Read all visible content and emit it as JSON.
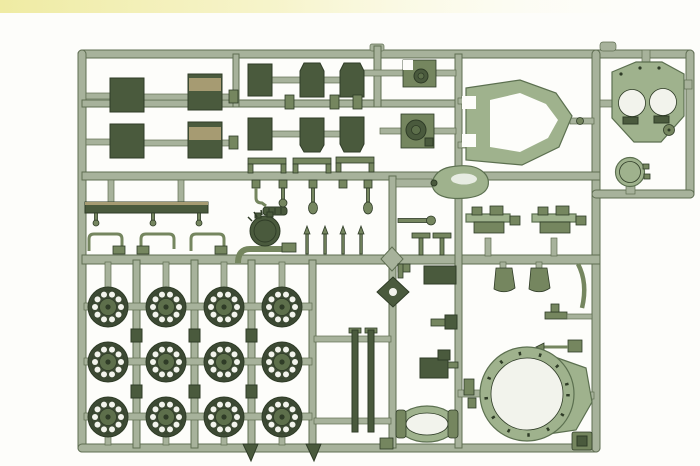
{
  "scene": {
    "description": "Photograph of an olive-green plastic model kit sprue (injection-molded parts tree) for a tank kit, laid on a white background with a pale yellow band along the top edge",
    "background_type": "plain white",
    "top_band": "pale yellow wash, strongest at the left"
  },
  "colors": {
    "background": "#fdfdfa",
    "top_band": "#f1eda6",
    "runner": "#a7b29b",
    "runner_edge": "#5f6e52",
    "part_dark": "#4a5a3d",
    "part_dark_edge": "#2f3c27",
    "part_mid": "#75865f",
    "part_light": "#9fb28d",
    "part_light_edge": "#5c7050",
    "tan": "#a69b72",
    "wheel_tire": "#3d4a34",
    "wheel_hub": "#5d6f4b",
    "hole": "#f2f3ec"
  },
  "sprue": {
    "material": "olive green styrene",
    "frame": "rounded rectangular runner frame with internal horizontal and vertical runners; separate small loop at top right",
    "parts": [
      {
        "name": "rectangular hatch panel",
        "count": 4
      },
      {
        "name": "angled plate (fender end)",
        "count": 4
      },
      {
        "name": "small rectangular plate",
        "count": 2
      },
      {
        "name": "mantlet / periscope block",
        "count": 2
      },
      {
        "name": "hull side frame (open hexagon)",
        "count": 1
      },
      {
        "name": "engine deck plate with two round fan openings",
        "count": 1
      },
      {
        "name": "round access hatch",
        "count": 1
      },
      {
        "name": "cupola dome",
        "count": 1
      },
      {
        "name": "long stowage bar with knobs",
        "count": 1
      },
      {
        "name": "towing bracket",
        "count": 3
      },
      {
        "name": "needle pin fitting",
        "count": 4
      },
      {
        "name": "bullet-shaped headlight",
        "count": 1
      },
      {
        "name": "suspension bogie mount",
        "count": 2
      },
      {
        "name": "mud flap",
        "count": 2
      },
      {
        "name": "curved fender blade",
        "count": 1
      },
      {
        "name": "road wheel with lightening holes",
        "count": 12
      },
      {
        "name": "barrel rod half",
        "count": 2
      },
      {
        "name": "oval fuel tank",
        "count": 1
      },
      {
        "name": "turret ring with flange",
        "count": 1
      },
      {
        "name": "gun cradle bracket",
        "count": 1
      },
      {
        "name": "corner pad plate",
        "count": 1
      }
    ]
  }
}
